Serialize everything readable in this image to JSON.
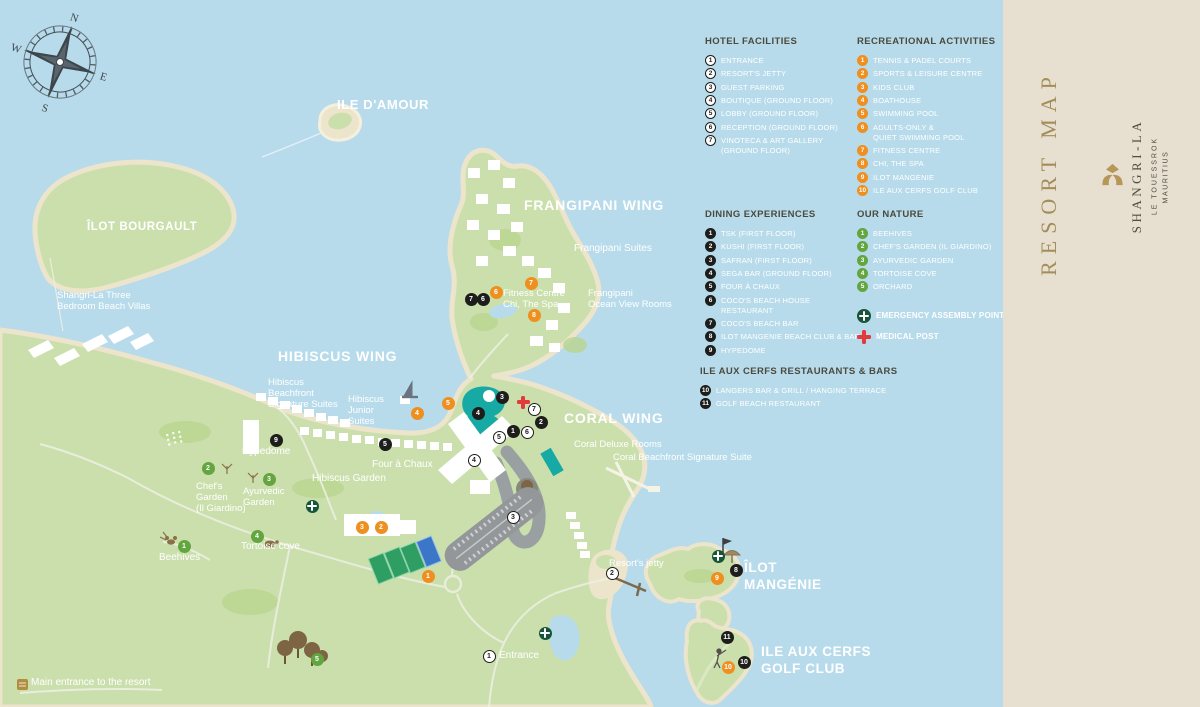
{
  "sidebar": {
    "resort_map": "RESORT MAP",
    "brand": "SHANGRI-LA",
    "sub1": "LE TOUESSROK",
    "sub2": "MAURITIUS"
  },
  "legend": {
    "hotel_facilities": {
      "title": "HOTEL FACILITIES",
      "items": [
        {
          "n": "1",
          "label": "ENTRANCE"
        },
        {
          "n": "2",
          "label": "RESORT'S JETTY"
        },
        {
          "n": "3",
          "label": "GUEST PARKING"
        },
        {
          "n": "4",
          "label": "BOUTIQUE (GROUND FLOOR)"
        },
        {
          "n": "5",
          "label": "LOBBY (GROUND FLOOR)"
        },
        {
          "n": "6",
          "label": "RECEPTION (GROUND FLOOR)"
        },
        {
          "n": "7",
          "label": "VINOTECA & ART GALLERY\n(GROUND FLOOR)"
        }
      ]
    },
    "recreational": {
      "title": "RECREATIONAL ACTIVITIES",
      "items": [
        {
          "n": "1",
          "label": "TENNIS & PADEL COURTS"
        },
        {
          "n": "2",
          "label": "SPORTS & LEISURE CENTRE"
        },
        {
          "n": "3",
          "label": "KIDS CLUB"
        },
        {
          "n": "4",
          "label": "BOATHOUSE"
        },
        {
          "n": "5",
          "label": "SWIMMING POOL"
        },
        {
          "n": "6",
          "label": "ADULTS-ONLY &\nQUIET SWIMMING POOL"
        },
        {
          "n": "7",
          "label": "FITNESS CENTRE"
        },
        {
          "n": "8",
          "label": "CHI, THE SPA"
        },
        {
          "n": "9",
          "label": "ILOT MANGENIE"
        },
        {
          "n": "10",
          "label": "ILE AUX CERFS GOLF CLUB"
        }
      ]
    },
    "dining": {
      "title": "DINING EXPERIENCES",
      "items": [
        {
          "n": "1",
          "label": "TSK (FIRST FLOOR)"
        },
        {
          "n": "2",
          "label": "KUSHI (FIRST FLOOR)"
        },
        {
          "n": "3",
          "label": "SAFRAN (FIRST FLOOR)"
        },
        {
          "n": "4",
          "label": "SEGA BAR (GROUND FLOOR)"
        },
        {
          "n": "5",
          "label": "FOUR À CHAUX"
        },
        {
          "n": "6",
          "label": "COCO'S BEACH HOUSE RESTAURANT"
        },
        {
          "n": "7",
          "label": "COCO'S BEACH BAR"
        },
        {
          "n": "8",
          "label": "ILOT MANGENIE BEACH CLUB & BAR"
        },
        {
          "n": "9",
          "label": "HYPEDOME"
        }
      ]
    },
    "nature": {
      "title": "OUR NATURE",
      "items": [
        {
          "n": "1",
          "label": "BEEHIVES"
        },
        {
          "n": "2",
          "label": "CHEF'S GARDEN (IL GIARDINO)"
        },
        {
          "n": "3",
          "label": "AYURVEDIC GARDEN"
        },
        {
          "n": "4",
          "label": "TORTOISE COVE"
        },
        {
          "n": "5",
          "label": "ORCHARD"
        }
      ]
    },
    "ile_aux_cerfs": {
      "title": "ILE AUX CERFS RESTAURANTS & BARS",
      "items": [
        {
          "n": "10",
          "label": "LANGERS BAR & GRILL / HANGING TERRACE"
        },
        {
          "n": "11",
          "label": "GOLF BEACH RESTAURANT"
        }
      ]
    },
    "emergency_label": "EMERGENCY ASSEMBLY POINT",
    "medical_label": "MEDICAL POST"
  },
  "map_labels": [
    {
      "t": "ILE D'AMOUR",
      "x": 337,
      "y": 97,
      "c": "med"
    },
    {
      "t": "ÎLOT BOURGAULT",
      "x": 87,
      "y": 220,
      "c": "med",
      "s": "11.5"
    },
    {
      "t": "Shangri-La Three\nBedroom Beach Villas",
      "x": 57,
      "y": 290,
      "c": "sm"
    },
    {
      "t": "FRANGIPANI WING",
      "x": 524,
      "y": 197,
      "c": "big"
    },
    {
      "t": "Frangipani Suites",
      "x": 574,
      "y": 243,
      "c": "sm",
      "s": "10"
    },
    {
      "t": "Fitness Centre\nChi, The Spa",
      "x": 503,
      "y": 288,
      "c": "sm"
    },
    {
      "t": "Frangipani\nOcean View Rooms",
      "x": 588,
      "y": 288,
      "c": "sm"
    },
    {
      "t": "HIBISCUS WING",
      "x": 278,
      "y": 348,
      "c": "big"
    },
    {
      "t": "Hibiscus\nBeachfront\nSignature Suites",
      "x": 268,
      "y": 377,
      "c": "sm"
    },
    {
      "t": "Hibiscus\nJunior\nSuites",
      "x": 348,
      "y": 394,
      "c": "sm"
    },
    {
      "t": "CORAL WING",
      "x": 564,
      "y": 410,
      "c": "big"
    },
    {
      "t": "Coral Deluxe Rooms",
      "x": 574,
      "y": 439,
      "c": "sm"
    },
    {
      "t": "Coral Beachfront Signature Suite",
      "x": 613,
      "y": 452,
      "c": "sm"
    },
    {
      "t": "Hypedome",
      "x": 242,
      "y": 446,
      "c": "sm",
      "s": "10"
    },
    {
      "t": "Chef's\nGarden\n(Il Giardino)",
      "x": 196,
      "y": 481,
      "c": "sm"
    },
    {
      "t": "Ayurvedic\nGarden",
      "x": 243,
      "y": 486,
      "c": "sm"
    },
    {
      "t": "Hibiscus Garden",
      "x": 312,
      "y": 473,
      "c": "sm",
      "s": "10"
    },
    {
      "t": "Four à Chaux",
      "x": 372,
      "y": 459,
      "c": "sm",
      "s": "10"
    },
    {
      "t": "Tortoise cove",
      "x": 241,
      "y": 541,
      "c": "sm",
      "s": "10"
    },
    {
      "t": "Beehives",
      "x": 159,
      "y": 552,
      "c": "sm",
      "s": "10"
    },
    {
      "t": "Resort's jetty",
      "x": 609,
      "y": 558,
      "c": "sm"
    },
    {
      "t": "ÎLOT\nMANGÉNIE",
      "x": 744,
      "y": 560,
      "c": "med",
      "s": "13.5"
    },
    {
      "t": "ILE AUX CERFS\nGOLF CLUB",
      "x": 761,
      "y": 644,
      "c": "med",
      "s": "13.5"
    },
    {
      "t": "Entrance",
      "x": 499,
      "y": 650,
      "c": "sm",
      "s": "10"
    },
    {
      "t": "Main entrance to the resort",
      "x": 31,
      "y": 677,
      "c": "sm",
      "s": "10"
    }
  ],
  "markers": [
    {
      "t": "f",
      "n": "1",
      "x": 489,
      "y": 656
    },
    {
      "t": "f",
      "n": "2",
      "x": 612,
      "y": 573
    },
    {
      "t": "f",
      "n": "3",
      "x": 513,
      "y": 517
    },
    {
      "t": "f",
      "n": "4",
      "x": 474,
      "y": 460
    },
    {
      "t": "f",
      "n": "5",
      "x": 499,
      "y": 437
    },
    {
      "t": "f",
      "n": "6",
      "x": 527,
      "y": 432
    },
    {
      "t": "f",
      "n": "7",
      "x": 534,
      "y": 409
    },
    {
      "t": "d",
      "n": "1",
      "x": 513,
      "y": 431
    },
    {
      "t": "d",
      "n": "2",
      "x": 541,
      "y": 422
    },
    {
      "t": "d",
      "n": "3",
      "x": 502,
      "y": 397
    },
    {
      "t": "d",
      "n": "4",
      "x": 478,
      "y": 413
    },
    {
      "t": "d",
      "n": "5",
      "x": 385,
      "y": 444
    },
    {
      "t": "d",
      "n": "6",
      "x": 483,
      "y": 299
    },
    {
      "t": "d",
      "n": "7",
      "x": 471,
      "y": 299
    },
    {
      "t": "d",
      "n": "8",
      "x": 736,
      "y": 570
    },
    {
      "t": "d",
      "n": "9",
      "x": 276,
      "y": 440
    },
    {
      "t": "d",
      "n": "10",
      "x": 744,
      "y": 662
    },
    {
      "t": "d",
      "n": "11",
      "x": 727,
      "y": 637
    },
    {
      "t": "r",
      "n": "1",
      "x": 428,
      "y": 576
    },
    {
      "t": "r",
      "n": "2",
      "x": 381,
      "y": 527
    },
    {
      "t": "r",
      "n": "3",
      "x": 362,
      "y": 527
    },
    {
      "t": "r",
      "n": "4",
      "x": 417,
      "y": 413
    },
    {
      "t": "r",
      "n": "5",
      "x": 448,
      "y": 403
    },
    {
      "t": "r",
      "n": "6",
      "x": 496,
      "y": 292
    },
    {
      "t": "r",
      "n": "7",
      "x": 531,
      "y": 283
    },
    {
      "t": "r",
      "n": "8",
      "x": 534,
      "y": 315
    },
    {
      "t": "r",
      "n": "9",
      "x": 717,
      "y": 578
    },
    {
      "t": "r",
      "n": "10",
      "x": 728,
      "y": 667
    },
    {
      "t": "n",
      "n": "1",
      "x": 184,
      "y": 546
    },
    {
      "t": "n",
      "n": "2",
      "x": 208,
      "y": 468
    },
    {
      "t": "n",
      "n": "3",
      "x": 269,
      "y": 479
    },
    {
      "t": "n",
      "n": "4",
      "x": 257,
      "y": 536
    },
    {
      "t": "n",
      "n": "5",
      "x": 317,
      "y": 659
    },
    {
      "t": "e",
      "n": "",
      "x": 312,
      "y": 506
    },
    {
      "t": "e",
      "n": "",
      "x": 545,
      "y": 633
    },
    {
      "t": "e",
      "n": "",
      "x": 718,
      "y": 556
    },
    {
      "t": "m",
      "n": "",
      "x": 523,
      "y": 402
    }
  ],
  "icons": {
    "compass-rose-icon": "8-point star with N/E/S/W",
    "emergency-assembly-icon": "dark green circle with white cross",
    "medical-post-icon": "red cross",
    "sailboat-icon": "grey sail boat",
    "umbrella-icon": "beach umbrella",
    "flag-icon": "flag pole",
    "golfer-icon": "golfer stick figure",
    "turtle-icon": "turtle",
    "bee-icon": "bee",
    "tree-icon": "orchard trees",
    "main-entrance-icon": "gold gate",
    "shangri-la-logo": "gold emblem"
  },
  "colors": {
    "water": "#b7dbeb",
    "land": "#cbdfad",
    "sand": "#ece5cc",
    "pool": "#17a9a4",
    "orange_marker": "#ee8f1f",
    "green_marker": "#63a53f",
    "black_marker": "#1d1d1b",
    "emergency_green": "#17543a",
    "medical_red": "#e23b3b",
    "sidebar_beige": "#e7dfd0",
    "gold": "#a38e59",
    "legend_header": "#4b4a3c"
  }
}
